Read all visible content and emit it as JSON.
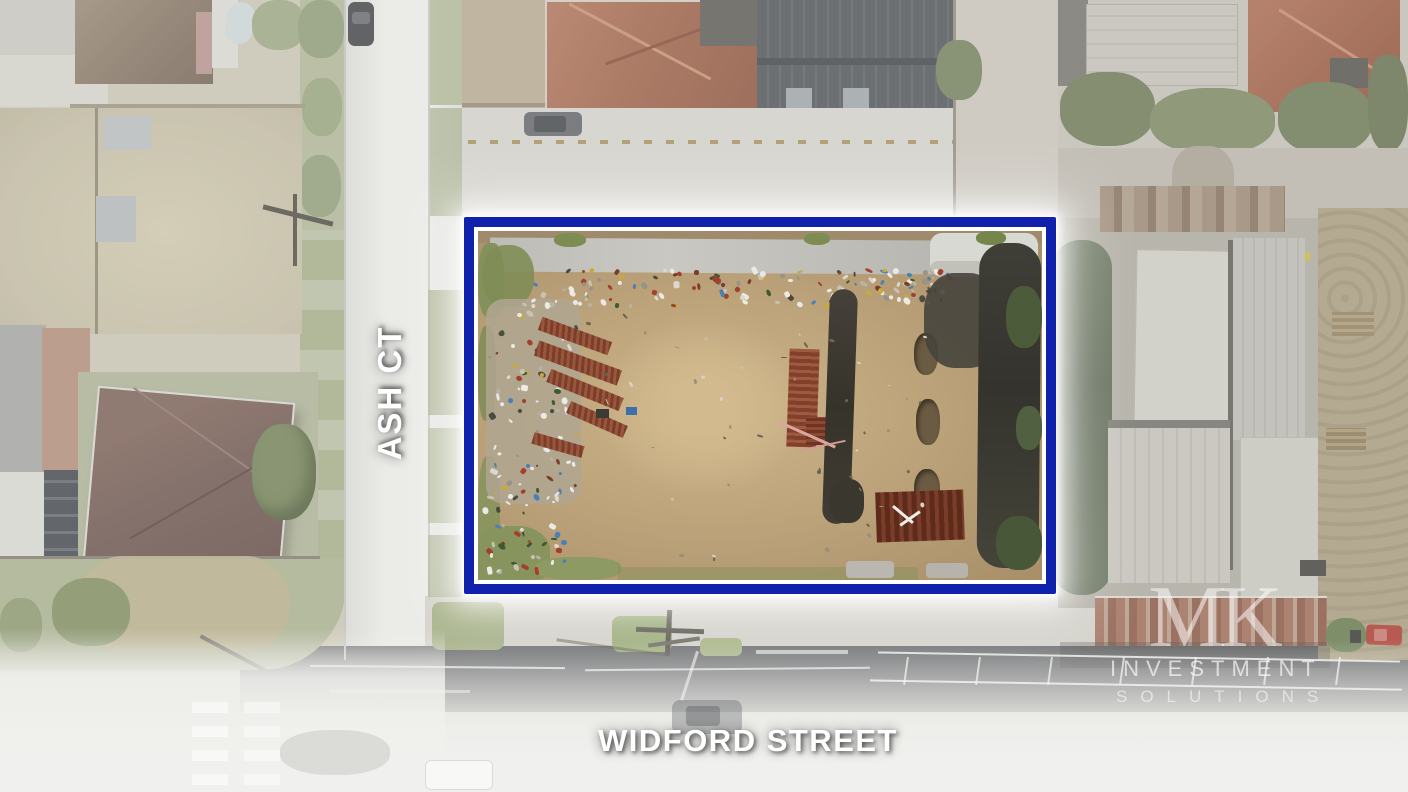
{
  "photo": {
    "alt": "Aerial drone photograph of a vacant corner site outlined in blue"
  },
  "labels": {
    "ash_ct": "ASH CT",
    "widford_street": "WIDFORD STREET"
  },
  "watermark": {
    "monogram": "MK",
    "line1": "INVESTMENT",
    "line2": "SOLUTIONS"
  },
  "colors": {
    "boundary_blue": "#1022ac",
    "boundary_inner_line": "#ffffff",
    "boundary_glow": "#ffffff",
    "label_text": "#ffffff"
  }
}
